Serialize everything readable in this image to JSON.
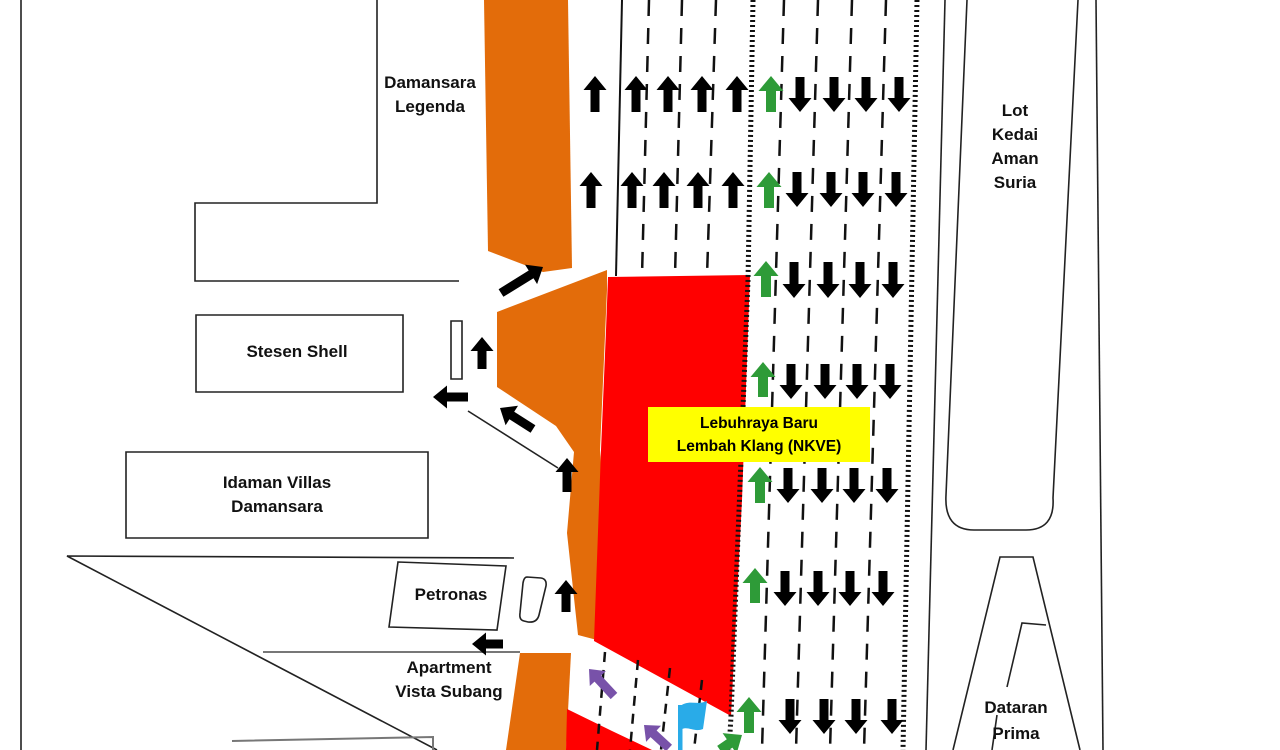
{
  "diagram": {
    "type": "traffic-management-plan",
    "labels": {
      "damansara_legenda": "Damansara\nLegenda",
      "stesen_shell": "Stesen Shell",
      "idaman_villas": "Idaman Villas\nDamansara",
      "petronas": "Petronas",
      "apartment_vista": "Apartment\nVista Subang",
      "lot_kedai": "Lot\nKedai\nAman\nSuria",
      "dataran_prima": "Dataran\nPrima",
      "highway_label": "Lebuhraya Baru\nLembah Klang (NKVE)"
    },
    "colors": {
      "work_zone_orange": "#E36C0A",
      "closure_red": "#FF0000",
      "open_lane_green": "#2E9B38",
      "diversion_purple": "#7852A9",
      "flag_blue": "#29ABE8",
      "highway_label_yellow": "#FFFF00",
      "traffic_black": "#000000",
      "line_dark": "#222222",
      "line_gray": "#777777"
    },
    "icons": {
      "flag": "flagman-flag-icon"
    },
    "arrow_styles": {
      "black": {
        "shaft": 9,
        "head_w": 23,
        "head_l": 14
      },
      "green": {
        "shaft": 10,
        "head_w": 25,
        "head_l": 15
      },
      "purple": {
        "shaft": 9,
        "head_w": 22,
        "head_l": 13
      }
    },
    "arrows": [
      {
        "name": "northbound-lane-flow-arrow",
        "color": "black",
        "items": [
          [
            595,
            112,
            595,
            76
          ],
          [
            636,
            112,
            636,
            76
          ],
          [
            668,
            112,
            668,
            76
          ],
          [
            702,
            112,
            702,
            76
          ],
          [
            737,
            112,
            737,
            76
          ],
          [
            591,
            208,
            591,
            172
          ],
          [
            632,
            208,
            632,
            172
          ],
          [
            664,
            208,
            664,
            172
          ],
          [
            698,
            208,
            698,
            172
          ],
          [
            733,
            208,
            733,
            172
          ]
        ]
      },
      {
        "name": "southbound-lane-flow-arrow",
        "color": "black",
        "items": [
          [
            800,
            77,
            800,
            112
          ],
          [
            834,
            77,
            834,
            112
          ],
          [
            866,
            77,
            866,
            112
          ],
          [
            899,
            77,
            899,
            112
          ],
          [
            797,
            172,
            797,
            207
          ],
          [
            831,
            172,
            831,
            207
          ],
          [
            863,
            172,
            863,
            207
          ],
          [
            896,
            172,
            896,
            207
          ],
          [
            794,
            262,
            794,
            298
          ],
          [
            828,
            262,
            828,
            298
          ],
          [
            860,
            262,
            860,
            298
          ],
          [
            893,
            262,
            893,
            298
          ],
          [
            791,
            364,
            791,
            399
          ],
          [
            825,
            364,
            825,
            399
          ],
          [
            857,
            364,
            857,
            399
          ],
          [
            890,
            364,
            890,
            399
          ],
          [
            788,
            468,
            788,
            503
          ],
          [
            822,
            468,
            822,
            503
          ],
          [
            854,
            468,
            854,
            503
          ],
          [
            887,
            468,
            887,
            503
          ],
          [
            785,
            571,
            785,
            606
          ],
          [
            818,
            571,
            818,
            606
          ],
          [
            850,
            571,
            850,
            606
          ],
          [
            883,
            571,
            883,
            606
          ],
          [
            790,
            699,
            790,
            734
          ],
          [
            824,
            699,
            824,
            734
          ],
          [
            856,
            699,
            856,
            734
          ],
          [
            892,
            699,
            892,
            734
          ]
        ]
      },
      {
        "name": "contraflow-open-lane-arrow",
        "color": "green",
        "items": [
          [
            771,
            112,
            771,
            76
          ],
          [
            769,
            208,
            769,
            172
          ],
          [
            766,
            297,
            766,
            261
          ],
          [
            763,
            397,
            763,
            362
          ],
          [
            760,
            503,
            760,
            467
          ],
          [
            755,
            603,
            755,
            568
          ],
          [
            749,
            733,
            749,
            697
          ],
          [
            720,
            750,
            742,
            735
          ]
        ]
      },
      {
        "name": "diversion-route-arrow",
        "color": "black",
        "items": [
          [
            501,
            293,
            543,
            267
          ],
          [
            482,
            369,
            482,
            337
          ],
          [
            468,
            397,
            433,
            397
          ],
          [
            533,
            429,
            500,
            408
          ],
          [
            567,
            492,
            567,
            458
          ],
          [
            566,
            612,
            566,
            580
          ],
          [
            503,
            644,
            472,
            644
          ]
        ]
      },
      {
        "name": "diverted-traffic-arrow",
        "color": "purple",
        "items": [
          [
            614,
            696,
            589,
            669
          ],
          [
            669,
            748,
            644,
            725
          ]
        ]
      }
    ]
  }
}
